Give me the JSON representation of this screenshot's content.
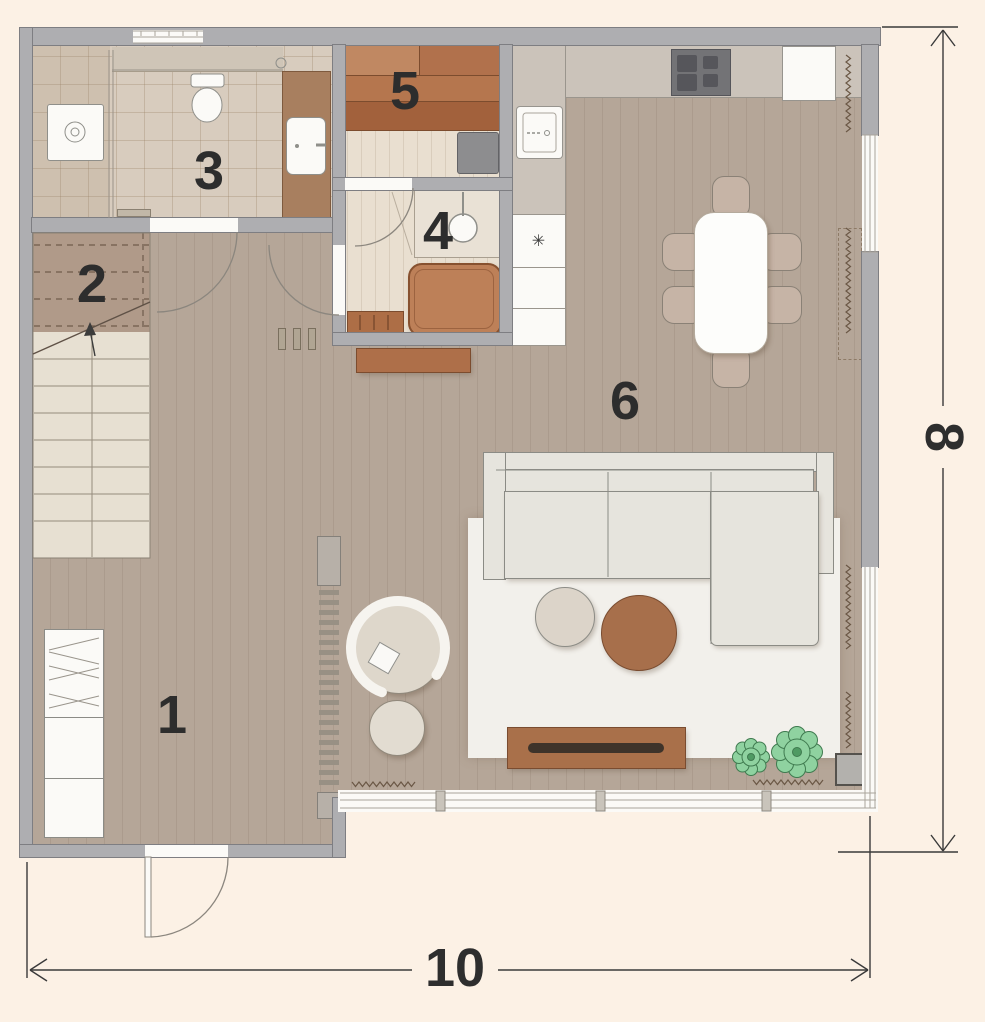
{
  "floorplan": {
    "background_color": "#fcf1e5",
    "rooms": [
      {
        "label": "1"
      },
      {
        "label": "2"
      },
      {
        "label": "3"
      },
      {
        "label": "4"
      },
      {
        "label": "5"
      },
      {
        "label": "6"
      }
    ],
    "dimensions": {
      "width": {
        "value": "10"
      },
      "height": {
        "value": "8"
      }
    },
    "kitchen": {
      "appliance_symbol": "✳"
    },
    "colors": {
      "wall": "#aeaeb1",
      "wood_floor": "#b5a698",
      "light_wood_floor": "#e9dfd0",
      "tile_floor": "#d8ccbe",
      "accent_brown": "#ae6f49",
      "sofa_upholstery": "#e6e4dd",
      "plant_green": "#8fd2a0",
      "dimension_line": "#3a3a3a"
    }
  }
}
